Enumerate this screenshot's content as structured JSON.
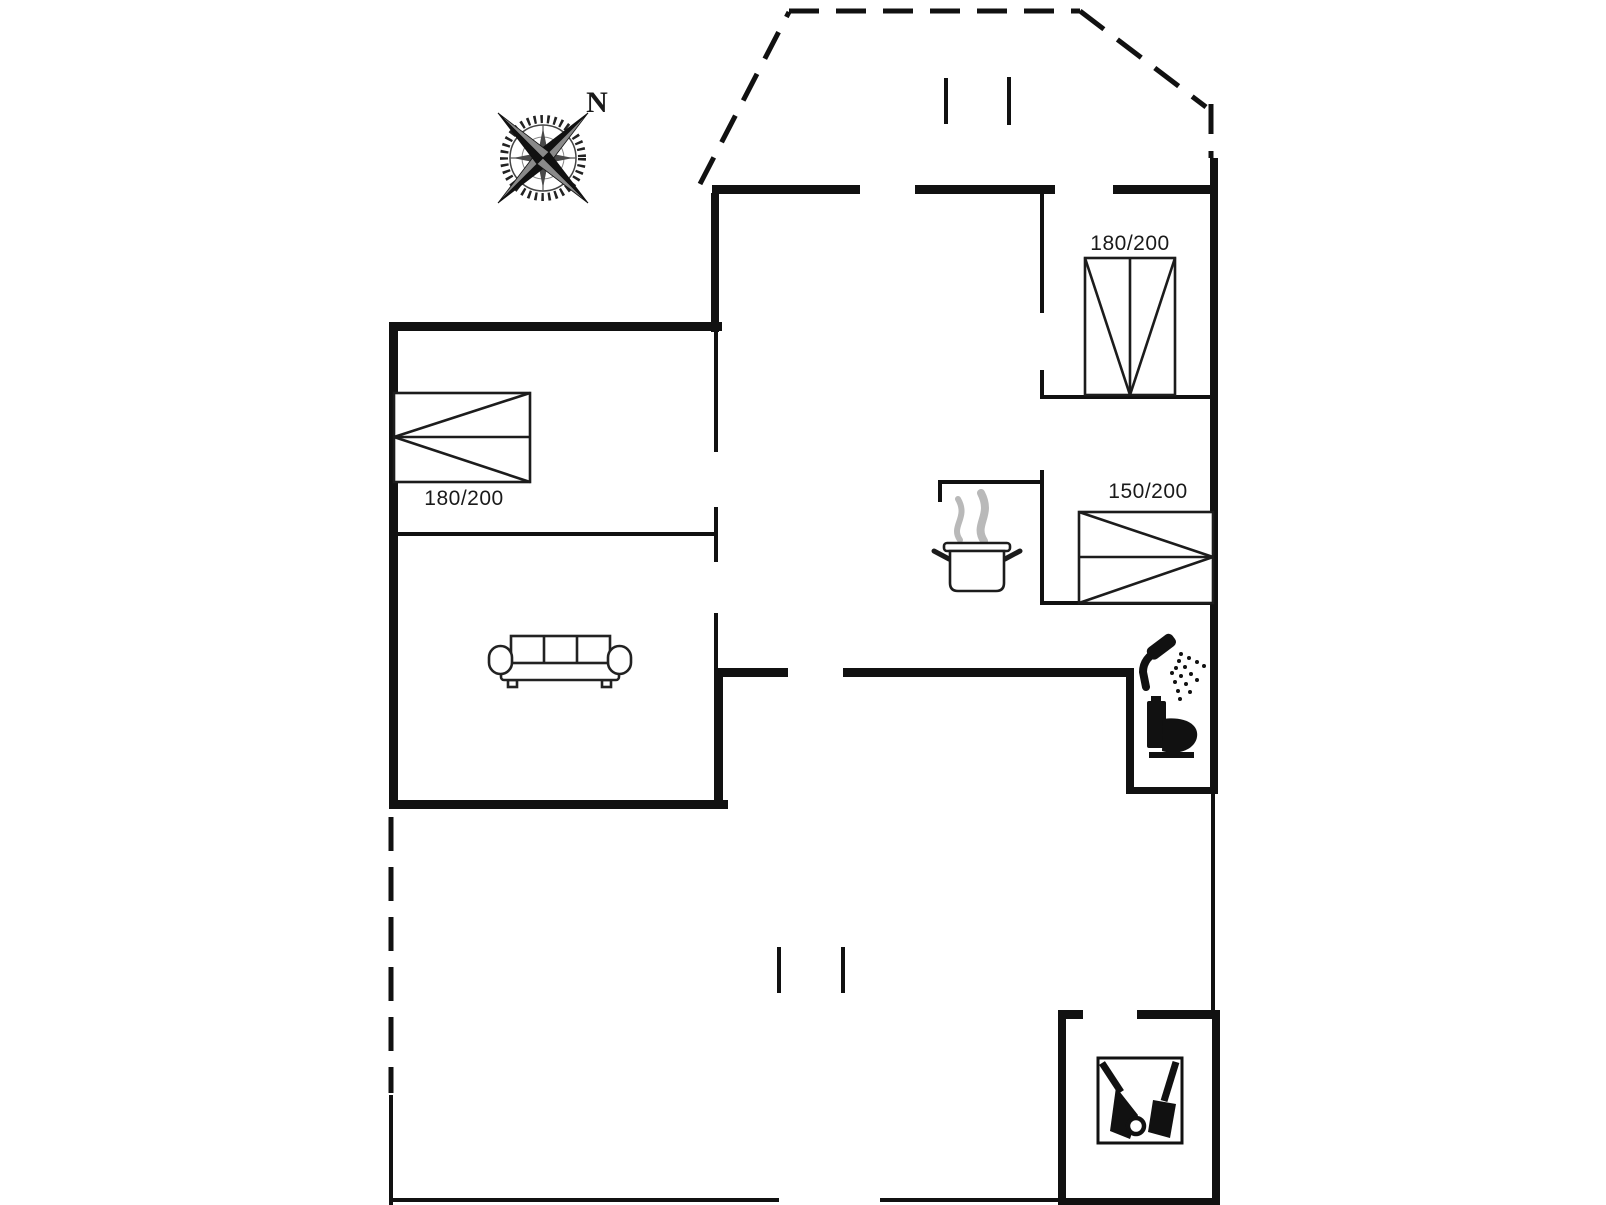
{
  "title": "Holiday home floor plan",
  "compass": {
    "north_label": "N"
  },
  "rooms": {
    "bedroom_left": {
      "bed_label": "180/200"
    },
    "bedroom_top_right": {
      "bed_label": "180/200"
    },
    "bedroom_right": {
      "bed_label": "150/200"
    }
  },
  "icons": {
    "compass": "compass-rose-icon",
    "sofa": "sofa-icon",
    "stove": "cooking-pot-icon",
    "shower": "shower-icon",
    "toilet": "toilet-icon",
    "utility": "cleaning-tools-icon"
  },
  "colors": {
    "wall": "#111111",
    "label": "#1a1a1a",
    "steam": "#b9b9b9",
    "background": "#ffffff"
  }
}
